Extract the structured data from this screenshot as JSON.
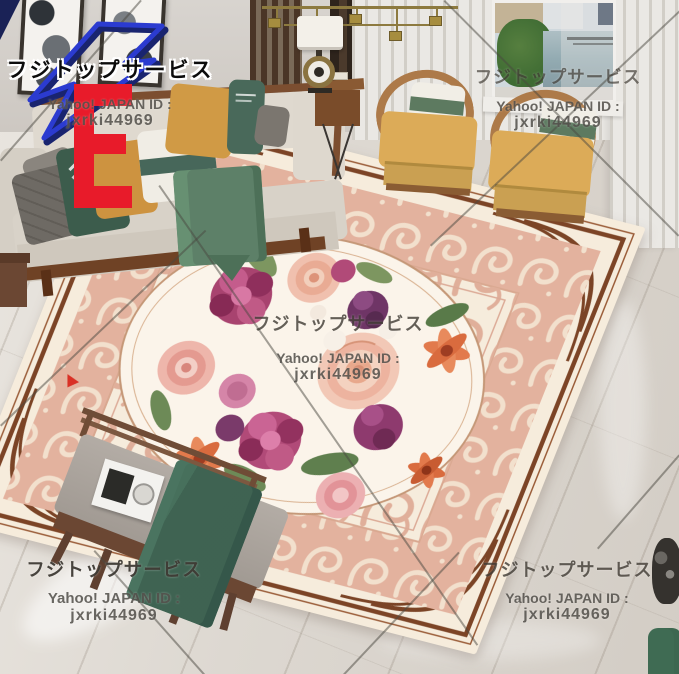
{
  "watermarks": {
    "service_name": "フジトップサービス",
    "id_label": "Yahoo! JAPAN ID :",
    "id_value": "jxrki44969"
  },
  "logo": {
    "letter": "E",
    "letter_color": "#e81b2a",
    "bolt_color": "#2b3bd0",
    "bolt_shadow_color": "#19246f"
  },
  "palette": {
    "rug_pink": "#e3b29e",
    "rug_cream": "#f6ecdc",
    "rug_border_brown": "#7b4426",
    "flower_magenta": "#b14a78",
    "flower_peach": "#edb39f",
    "flower_orange": "#e27a4c",
    "pillow_green": "#3c5c4c",
    "pillow_mustard": "#cd9340",
    "sofa_beige": "#d8d2c8",
    "blanket_green": "#3f6352",
    "floor_marble": "#ddd8d1",
    "chair_wood": "#ad7a49"
  }
}
